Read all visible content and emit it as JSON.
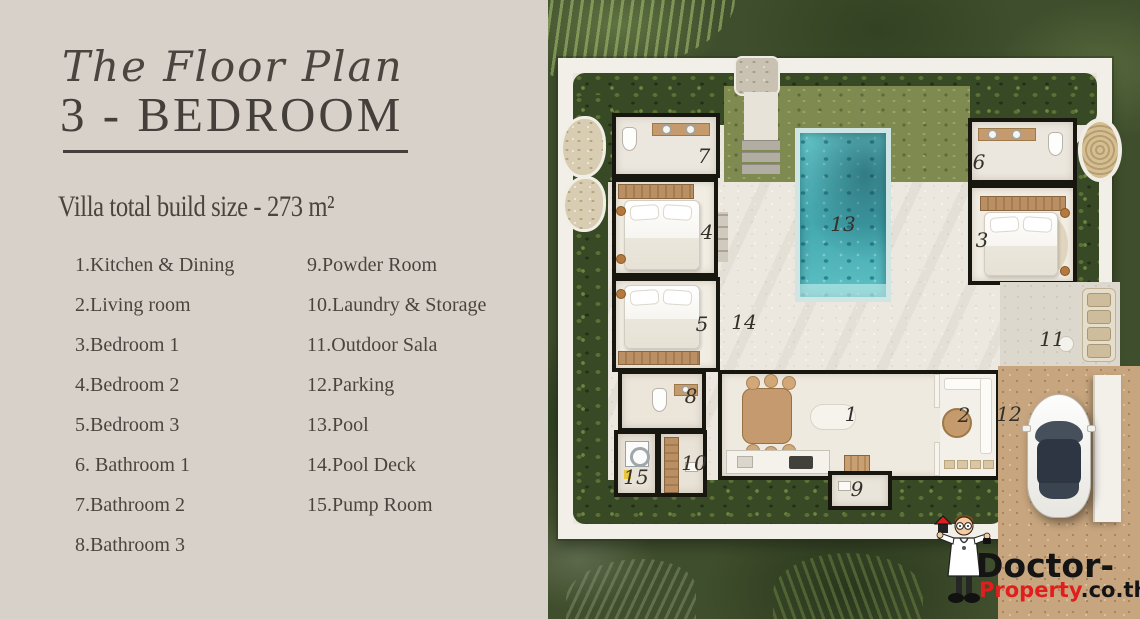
{
  "panel": {
    "title_script": "The Floor Plan",
    "title_main": "3 - BEDROOM",
    "subtitle": "Villa total build size - 273 m²",
    "legend_col1": [
      "1.Kitchen & Dining",
      "2.Living room",
      "3.Bedroom 1",
      "4.Bedroom 2",
      "5.Bedroom 3",
      "6. Bathroom 1",
      "7.Bathroom 2",
      "8.Bathroom 3"
    ],
    "legend_col2": [
      "9.Powder Room",
      "10.Laundry & Storage",
      "11.Outdoor Sala",
      "12.Parking",
      "13.Pool",
      "14.Pool Deck",
      "15.Pump Room"
    ]
  },
  "plan": {
    "room_numbers": {
      "r1": "1",
      "r2": "2",
      "r3": "3",
      "r4": "4",
      "r5": "5",
      "r6": "6",
      "r7": "7",
      "r8": "8",
      "r9": "9",
      "r10": "10",
      "r11": "11",
      "r12": "12",
      "r13": "13",
      "r14": "14",
      "r15": "15"
    }
  },
  "watermark": {
    "line1": "Doctor-",
    "brand": "Property",
    "tld": ".co.th"
  },
  "colors": {
    "panel_bg": "#d8d1ca",
    "ink": "#453f3b",
    "pool": "#50b7bc",
    "foliage": "#3f4e2c",
    "deck": "#ece8e0",
    "dirt": "#c7a57e",
    "wall_white": "#f2efe9",
    "brand_red": "#e01e1e"
  }
}
